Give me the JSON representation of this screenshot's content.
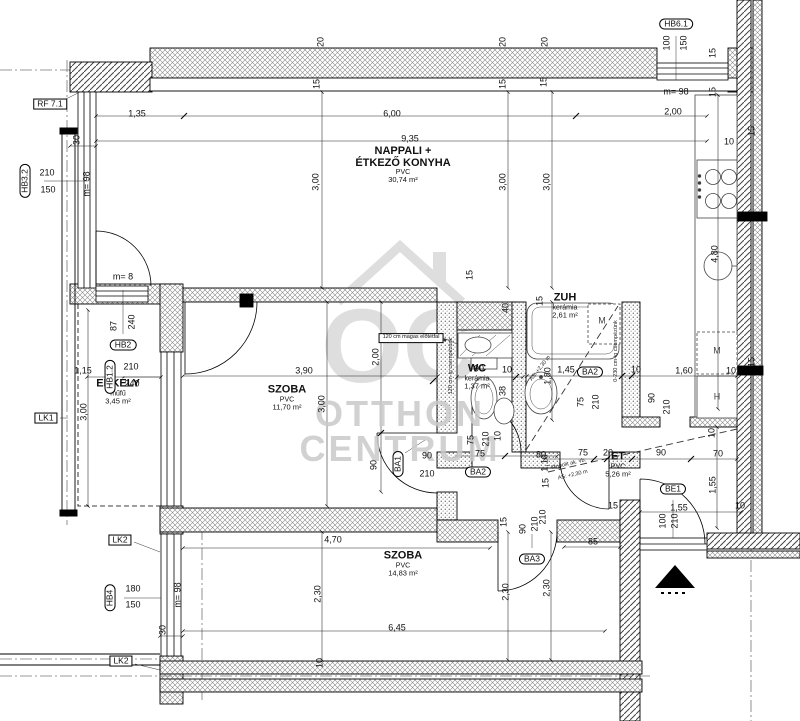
{
  "watermark": {
    "logo_text": "OC",
    "line1": "OTTHON",
    "line2": "CENTRUM"
  },
  "rooms": [
    {
      "lines": [
        "NAPPALI +",
        "ÉTKEZŐ KONYHA"
      ],
      "floor": "PVC",
      "area": "30,74 m²",
      "x": 403,
      "y": 165
    },
    {
      "lines": [
        "SZOBA"
      ],
      "floor": "PVC",
      "area": "11,70 m²",
      "x": 287,
      "y": 398
    },
    {
      "lines": [
        "ERKÉLY"
      ],
      "floor": "műfű",
      "area": "3,45 m²",
      "x": 118,
      "y": 392
    },
    {
      "lines": [
        "WC"
      ],
      "floor": "kerámia",
      "area": "1,37 m²",
      "x": 477,
      "y": 377
    },
    {
      "lines": [
        "ZUH"
      ],
      "floor": "kerámia",
      "area": "2,61 m²",
      "x": 565,
      "y": 306
    },
    {
      "lines": [
        "ET"
      ],
      "floor": "PVC",
      "area": "5,26 m²",
      "x": 618,
      "y": 465
    },
    {
      "lines": [
        "SZOBA"
      ],
      "floor": "PVC",
      "area": "14,83 m²",
      "x": 403,
      "y": 564
    }
  ],
  "tags": [
    {
      "t": "HB3.2",
      "x": 25,
      "y": 181,
      "r": -90
    },
    {
      "t": "HB2",
      "x": 123,
      "y": 345,
      "r": 0
    },
    {
      "t": "HB1.2",
      "x": 110,
      "y": 377,
      "r": -90
    },
    {
      "t": "HB6.1",
      "x": 676,
      "y": 24,
      "r": 0
    },
    {
      "t": "HB4",
      "x": 110,
      "y": 598,
      "r": -90
    },
    {
      "t": "BA1",
      "x": 398,
      "y": 464,
      "r": -90
    },
    {
      "t": "BA2",
      "x": 478,
      "y": 472,
      "r": 0
    },
    {
      "t": "BA2",
      "x": 590,
      "y": 372,
      "r": 0
    },
    {
      "t": "BA3",
      "x": 532,
      "y": 559,
      "r": 0
    },
    {
      "t": "BE1",
      "x": 673,
      "y": 489,
      "r": 0
    }
  ],
  "ref_boxes": [
    {
      "t": "RF 7.1",
      "x": 50,
      "y": 104
    },
    {
      "t": "LK1",
      "x": 46,
      "y": 418
    },
    {
      "t": "LK2",
      "x": 120,
      "y": 540
    },
    {
      "t": "LK2",
      "x": 121,
      "y": 661
    }
  ],
  "dims": [
    {
      "t": "1,35",
      "x": 137,
      "y": 114,
      "r": 0
    },
    {
      "t": "6,00",
      "x": 392,
      "y": 114,
      "r": 0
    },
    {
      "t": "2,00",
      "x": 673,
      "y": 112,
      "r": 0
    },
    {
      "t": "9,35",
      "x": 410,
      "y": 139,
      "r": 0
    },
    {
      "t": "20",
      "x": 321,
      "y": 42,
      "r": -90
    },
    {
      "t": "15",
      "x": 317,
      "y": 84,
      "r": -90
    },
    {
      "t": "20",
      "x": 503,
      "y": 42,
      "r": -90
    },
    {
      "t": "15",
      "x": 503,
      "y": 84,
      "r": -90
    },
    {
      "t": "20",
      "x": 545,
      "y": 42,
      "r": -90
    },
    {
      "t": "15",
      "x": 544,
      "y": 82,
      "r": -90
    },
    {
      "t": "3,00",
      "x": 316,
      "y": 182,
      "r": -90
    },
    {
      "t": "3,00",
      "x": 503,
      "y": 182,
      "r": -90
    },
    {
      "t": "3,00",
      "x": 547,
      "y": 182,
      "r": -90
    },
    {
      "t": "100",
      "x": 667,
      "y": 43,
      "r": -90
    },
    {
      "t": "150",
      "x": 684,
      "y": 43,
      "r": -90
    },
    {
      "t": "m= 98",
      "x": 676,
      "y": 92,
      "r": 0
    },
    {
      "t": "15",
      "x": 713,
      "y": 53,
      "r": -90
    },
    {
      "t": "15",
      "x": 713,
      "y": 92,
      "r": -90
    },
    {
      "t": "15",
      "x": 752,
      "y": 131,
      "r": -90
    },
    {
      "t": "10",
      "x": 729,
      "y": 142,
      "r": 0
    },
    {
      "t": "30",
      "x": 77,
      "y": 140,
      "r": -90
    },
    {
      "t": "m= 98",
      "x": 87,
      "y": 184,
      "r": -90
    },
    {
      "t": "210",
      "x": 47,
      "y": 173,
      "r": 0
    },
    {
      "t": "150",
      "x": 48,
      "y": 190,
      "r": 0
    },
    {
      "t": "m= 8",
      "x": 123,
      "y": 277,
      "r": 0
    },
    {
      "t": "87",
      "x": 114,
      "y": 326,
      "r": -90
    },
    {
      "t": "240",
      "x": 132,
      "y": 322,
      "r": -90
    },
    {
      "t": "210",
      "x": 131,
      "y": 367,
      "r": 0
    },
    {
      "t": "240",
      "x": 132,
      "y": 384,
      "r": 0
    },
    {
      "t": "1,15",
      "x": 83,
      "y": 371,
      "r": 0
    },
    {
      "t": "3,00",
      "x": 84,
      "y": 412,
      "r": -90
    },
    {
      "t": "3,90",
      "x": 304,
      "y": 371,
      "r": 0
    },
    {
      "t": "3,00",
      "x": 322,
      "y": 404,
      "r": -90
    },
    {
      "t": "2,00",
      "x": 376,
      "y": 357,
      "r": -90
    },
    {
      "t": "90",
      "x": 374,
      "y": 465,
      "r": -90
    },
    {
      "t": "15",
      "x": 470,
      "y": 275,
      "r": -90
    },
    {
      "t": "40",
      "x": 506,
      "y": 308,
      "r": -90
    },
    {
      "t": "15",
      "x": 540,
      "y": 301,
      "r": -90
    },
    {
      "t": "90",
      "x": 479,
      "y": 369,
      "r": 0
    },
    {
      "t": "10",
      "x": 507,
      "y": 370,
      "r": 0
    },
    {
      "t": "38",
      "x": 503,
      "y": 391,
      "r": -90
    },
    {
      "t": "1,45",
      "x": 566,
      "y": 370,
      "r": 0
    },
    {
      "t": "10",
      "x": 636,
      "y": 370,
      "r": 0
    },
    {
      "t": "1,60",
      "x": 684,
      "y": 371,
      "r": 0
    },
    {
      "t": "10",
      "x": 731,
      "y": 371,
      "r": 0
    },
    {
      "t": "1,80",
      "x": 548,
      "y": 376,
      "r": -90
    },
    {
      "t": "4,80",
      "x": 715,
      "y": 254,
      "r": -90
    },
    {
      "t": "75",
      "x": 581,
      "y": 402,
      "r": -90
    },
    {
      "t": "210",
      "x": 596,
      "y": 402,
      "r": -90
    },
    {
      "t": "90",
      "x": 652,
      "y": 398,
      "r": -90
    },
    {
      "t": "210",
      "x": 667,
      "y": 407,
      "r": -90
    },
    {
      "t": "10",
      "x": 712,
      "y": 433,
      "r": -90
    },
    {
      "t": "15",
      "x": 752,
      "y": 362,
      "r": -90
    },
    {
      "t": "75",
      "x": 471,
      "y": 440,
      "r": -90
    },
    {
      "t": "210",
      "x": 486,
      "y": 439,
      "r": -90
    },
    {
      "t": "10",
      "x": 498,
      "y": 436,
      "r": -90
    },
    {
      "t": "90",
      "x": 427,
      "y": 456,
      "r": 0
    },
    {
      "t": "210",
      "x": 427,
      "y": 474,
      "r": 0
    },
    {
      "t": "75",
      "x": 480,
      "y": 454,
      "r": 0
    },
    {
      "t": "80",
      "x": 541,
      "y": 455,
      "r": 0
    },
    {
      "t": "75",
      "x": 583,
      "y": 453,
      "r": 0
    },
    {
      "t": "20",
      "x": 608,
      "y": 453,
      "r": 0
    },
    {
      "t": "90",
      "x": 661,
      "y": 453,
      "r": 0
    },
    {
      "t": "70",
      "x": 718,
      "y": 454,
      "r": 0
    },
    {
      "t": "1,10",
      "x": 545,
      "y": 463,
      "r": -90
    },
    {
      "t": "1,55",
      "x": 713,
      "y": 485,
      "r": -90
    },
    {
      "t": "15",
      "x": 546,
      "y": 483,
      "r": -90
    },
    {
      "t": "210",
      "x": 543,
      "y": 517,
      "r": -90
    },
    {
      "t": "15",
      "x": 613,
      "y": 506,
      "r": 0
    },
    {
      "t": "85",
      "x": 593,
      "y": 542,
      "r": 0
    },
    {
      "t": "15",
      "x": 504,
      "y": 522,
      "r": -90
    },
    {
      "t": "90",
      "x": 523,
      "y": 529,
      "r": -90
    },
    {
      "t": "210",
      "x": 535,
      "y": 524,
      "r": -90
    },
    {
      "t": "1,55",
      "x": 679,
      "y": 508,
      "r": 0
    },
    {
      "t": "10",
      "x": 740,
      "y": 506,
      "r": 0
    },
    {
      "t": "100",
      "x": 663,
      "y": 521,
      "r": -90
    },
    {
      "t": "210",
      "x": 675,
      "y": 521,
      "r": -90
    },
    {
      "t": "4,70",
      "x": 333,
      "y": 540,
      "r": 0
    },
    {
      "t": "2,30",
      "x": 318,
      "y": 594,
      "r": -90
    },
    {
      "t": "2,30",
      "x": 506,
      "y": 592,
      "r": -90
    },
    {
      "t": "2,30",
      "x": 547,
      "y": 588,
      "r": -90
    },
    {
      "t": "6,45",
      "x": 397,
      "y": 628,
      "r": 0
    },
    {
      "t": "180",
      "x": 133,
      "y": 589,
      "r": 0
    },
    {
      "t": "150",
      "x": 133,
      "y": 605,
      "r": 0
    },
    {
      "t": "m= 98",
      "x": 178,
      "y": 595,
      "r": -90
    },
    {
      "t": "30",
      "x": 163,
      "y": 630,
      "r": -90
    },
    {
      "t": "10",
      "x": 320,
      "y": 663,
      "r": -90
    }
  ],
  "notes": [
    {
      "t": "120 cm magas előtétfal",
      "x": 411,
      "y": 338,
      "r": 0,
      "box": true
    },
    {
      "t": "120 cm-ig csempézünk",
      "x": 452,
      "y": 366,
      "r": -90,
      "box": false
    },
    {
      "t": "0-230 cm-ig csempézünk",
      "x": 617,
      "y": 351,
      "r": -90,
      "box": false
    },
    {
      "t": "Monolit ak. vb.",
      "x": 569,
      "y": 465,
      "r": -13,
      "box": false
    },
    {
      "t": "AS: +2,30 m",
      "x": 573,
      "y": 476,
      "r": -13,
      "box": false
    },
    {
      "t": "AS: +2,30 m",
      "x": 541,
      "y": 369,
      "r": -52,
      "box": false
    }
  ],
  "appliances": [
    {
      "t": "M",
      "x": 602,
      "y": 321
    },
    {
      "t": "M",
      "x": 717,
      "y": 351
    },
    {
      "t": "H",
      "x": 717,
      "y": 397
    }
  ]
}
